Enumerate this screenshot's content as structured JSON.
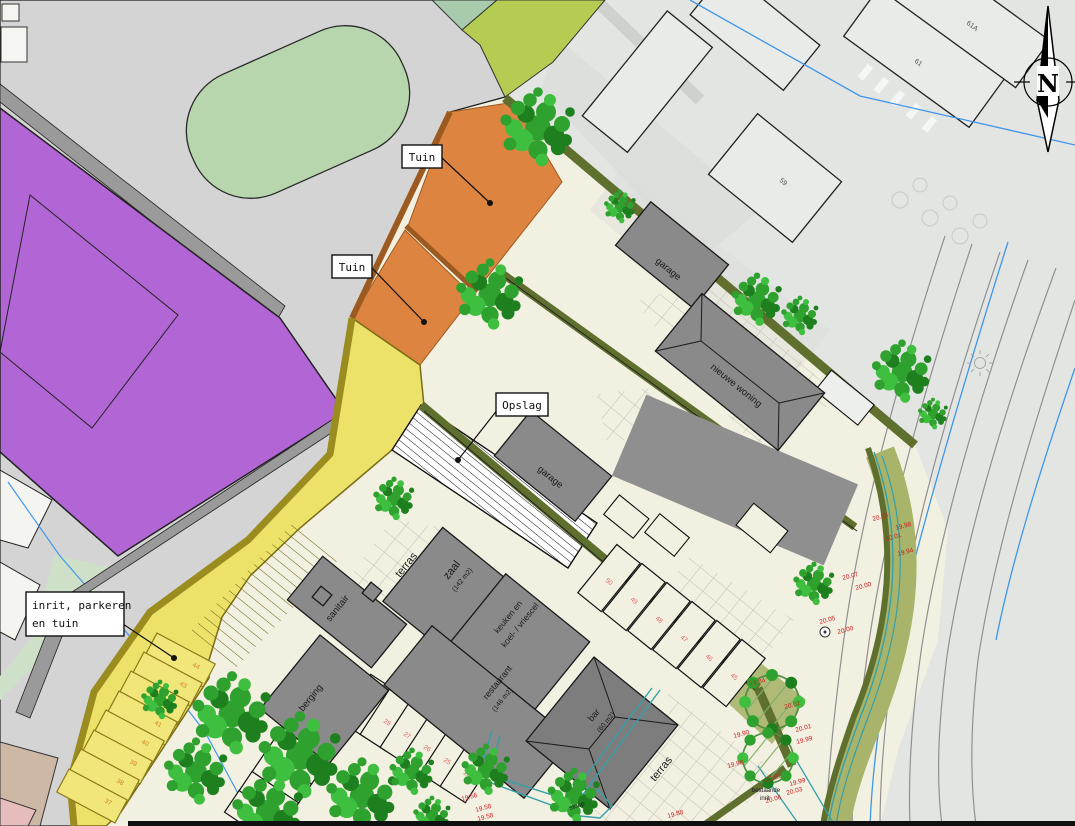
{
  "callouts": {
    "tuin1": "Tuin",
    "tuin2": "Tuin",
    "opslag": "Opslag",
    "inrit_line1": "inrit, parkeren",
    "inrit_line2": "en tuin"
  },
  "rooms": {
    "zaal": "zaal",
    "zaal_area": "(142 m2)",
    "keuken_line1": "keuken en",
    "keuken_line2": "koel- / vriescel",
    "restaurant": "restaurant",
    "restaurant_area": "(146 m2)",
    "bar": "bar",
    "bar_area": "(60 m2)",
    "sanitair": "sanitair",
    "berging": "berging",
    "terras_upper": "terras",
    "terras_lower": "terras",
    "stoep": "stoep"
  },
  "buildings": {
    "garage_north": "garage",
    "garage_mid": "garage",
    "nieuwe_woning": "nieuwe woning",
    "bestaande_line1": "bestaande",
    "bestaande_line2": "inrit",
    "house_59": "59",
    "house_61": "61",
    "house_61a": "61A"
  },
  "north_arrow": {
    "label": "N"
  },
  "parking": {
    "row_a": [
      "50",
      "49",
      "48",
      "47",
      "46",
      "45"
    ],
    "row_b": [
      "29",
      "28",
      "27",
      "26",
      "25",
      "24"
    ],
    "row_c": [
      "30",
      "31",
      "32",
      "33",
      "34"
    ],
    "row_d": [
      "44",
      "43",
      "42",
      "41",
      "40",
      "39",
      "38",
      "37"
    ]
  },
  "elevations": [
    "20.05",
    "19.98",
    "20.01",
    "19.94",
    "20.07",
    "20.00",
    "20.05",
    "20.00",
    "19.84",
    "19.90",
    "19.98",
    "20.02",
    "20.01",
    "19.99",
    "20.02",
    "19.99",
    "20.03",
    "20.06",
    "19.56",
    "19.58",
    "19.58",
    "19.88"
  ],
  "colors": {
    "cream": "#f2f0e1",
    "plaza": "#d4d4d4",
    "photo": "#e3e5e3",
    "purple": "#b266d6",
    "orange": "#dd8441",
    "yellow": "#ece26a",
    "hedge_olive": "#5f6f2e",
    "verge_olive": "#a9b46b",
    "building_gray": "#8a8a8a",
    "green_ellipse": "#b7d6ad",
    "lime": "#b5cc52",
    "tree_green": "#2ea12e",
    "marker_red": "#cc2222",
    "water_blue": "#3f96e8",
    "teal": "#35a0aa"
  }
}
